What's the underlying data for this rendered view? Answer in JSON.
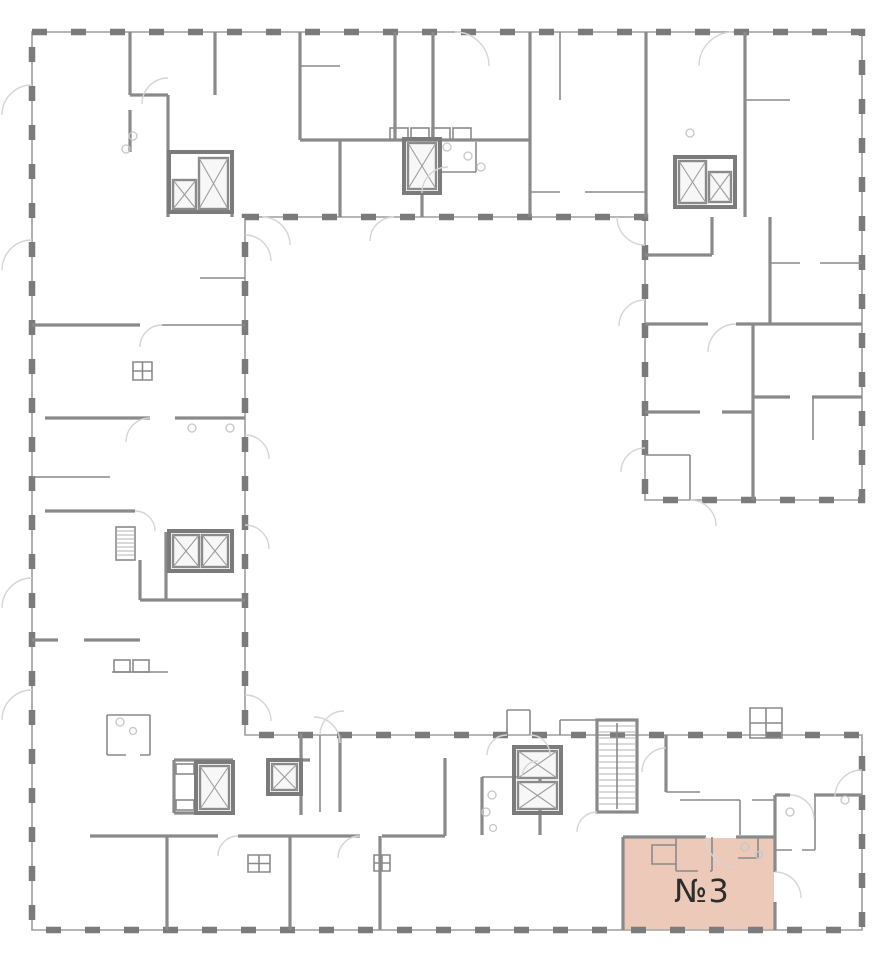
{
  "floor_plan": {
    "selected_unit": {
      "label": "№3",
      "fill_color": "#ecc9b8",
      "label_color": "#2d2d2d"
    },
    "colors": {
      "background": "#ffffff",
      "wall_dark": "#7b7b7b",
      "wall_medium": "#8a8a8a",
      "wall_light": "#9d9d9d",
      "door_arc": "#d5d5d5",
      "fixture": "#c6c6c6",
      "shaft_fill": "#f7f7f7",
      "stair_step": "#b3b3b3"
    }
  }
}
